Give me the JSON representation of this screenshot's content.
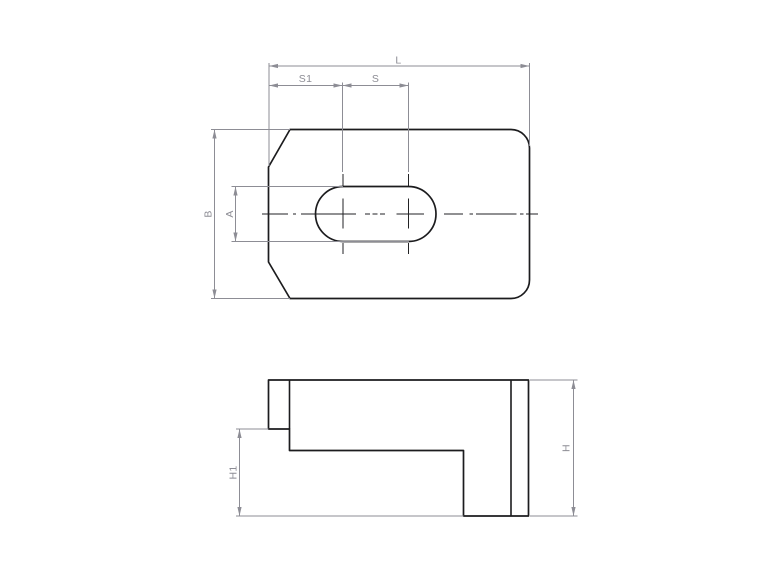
{
  "labels": {
    "L": "L",
    "S1": "S1",
    "S": "S",
    "B": "B",
    "A": "A",
    "H": "H",
    "H1": "H1"
  },
  "colors": {
    "background": "#ffffff",
    "outline": "#1c1c1e",
    "dimension": "#8d8d95",
    "centerline": "#222224"
  }
}
